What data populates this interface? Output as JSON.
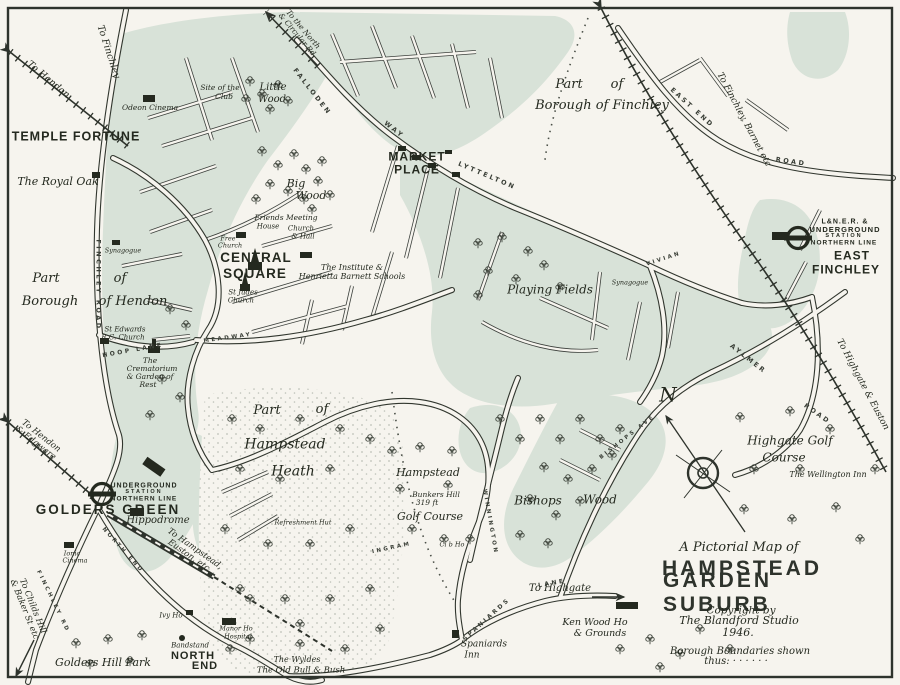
{
  "map_title": "A Pictorial Map of Hampstead Garden Suburb",
  "colors": {
    "paper": "#f6f4ee",
    "suburb_green": "#d8e2d8",
    "ink": "#2e332c"
  },
  "compass": {
    "n": "N"
  },
  "title_block": {
    "pretitle": "A Pictorial Map of",
    "title1": "HAMPSTEAD",
    "title2": "GARDEN SUBURB",
    "copyright1": "Copyright by",
    "copyright2": "The Blandford Studio",
    "copyright3": "1946.",
    "legend1": "Borough Boundaries shown",
    "legend2": "thus: · · · · · ·"
  },
  "stations": {
    "east_finchley": {
      "railway": "L&N.E.R. &",
      "underground": "UNDERGROUND",
      "station": "STATION",
      "line": "NORTHERN LINE",
      "name1": "EAST",
      "name2": "FINCHLEY"
    },
    "golders_green": {
      "underground": "UNDERGROUND",
      "station": "STATION",
      "line": "NORTHERN LINE",
      "name": "GOLDERS GREEN"
    }
  },
  "labels": {
    "temple_fortune": "TEMPLE FORTUNE",
    "market_place": [
      "MARKET",
      "PLACE"
    ],
    "central_square": [
      "CENTRAL",
      "SQUARE"
    ],
    "north_end": [
      "NORTH",
      "END"
    ],
    "royal_oak": "The Royal Oak",
    "hendon_part": [
      "Part",
      "of",
      "Borough",
      "of Hendon"
    ],
    "finchley_part": [
      "Part",
      "of",
      "Borough of Finchley"
    ],
    "little_wood": [
      "Little",
      "Wood"
    ],
    "big_wood": [
      "Big",
      "Wood"
    ],
    "site_of_club": [
      "Site of the",
      "Club"
    ],
    "odeon_cinema": "Odeon Cinema",
    "friends_meeting": [
      "Friends Meeting",
      "House"
    ],
    "church_hall": [
      "Church",
      "& Hall"
    ],
    "free_church": [
      "Free",
      "Church"
    ],
    "st_judes": [
      "St Judes",
      "Church"
    ],
    "institute": [
      "The Institute &",
      "Henrietta Barnett Schools"
    ],
    "synagogue_w": "Synagogue",
    "synagogue_e": "Synagogue",
    "st_edwards": [
      "St Edwards",
      "R.C. Church"
    ],
    "crematorium": [
      "The",
      "Crematorium",
      "& Garden of",
      "Rest"
    ],
    "playing_fields": "Playing Fields",
    "heath_part": [
      "Part",
      "of",
      "Hampstead",
      "Heath"
    ],
    "hampstead_golf": [
      "Hampstead",
      "Bunkers Hill",
      "319 ft",
      "Golf Course"
    ],
    "club_ho": "Cl b Ho",
    "bishops_wood": [
      "Bishops",
      "Wood"
    ],
    "highgate_golf": [
      "Highgate Golf",
      "Course"
    ],
    "wellington": "The Wellington Inn",
    "ken_wood": [
      "Ken Wood Ho",
      "& Grounds"
    ],
    "spaniards": [
      "Spaniards",
      "Inn"
    ],
    "wyldes": "The Wyldes",
    "old_bull": "The Old Bull & Bush",
    "golders_hill": "Golders Hill Park",
    "bandstand": "Bandstand",
    "ivy_ho": "Ivy Ho",
    "hippodrome": "Hippodrome",
    "ionic": [
      "Ionic",
      "Cinema"
    ],
    "refreshment": "Refreshment Hut",
    "manor": [
      "Manor Ho",
      "Hospital"
    ]
  },
  "roads": {
    "finchley_road": "FINCHLEY ROAD",
    "finchley2": "FINCHLEY RD",
    "hoop_lane": "HOOP LANE",
    "falloden": "FALLODEN",
    "way": "WAY",
    "lyttelton": "LYTTELTON",
    "east_end": "EAST END",
    "road_e": "ROAD",
    "aylmer": "AYLMER",
    "meadway": "MEADWAY",
    "vivian": "VIVIAN",
    "bishops_ave": "BISHOPS AVE",
    "winnington": "WINNINGTON",
    "spaniards_rd": "SPANIARDS",
    "lane": "LANE",
    "ingram": "INGRAM",
    "north_end_rd": "NORTH END",
    "road_s": "ROAD"
  },
  "directions": {
    "hendon": "To Hendon",
    "finchley": "To Finchley",
    "north": [
      "To the North",
      "& Circular Rd"
    ],
    "finchley_barnet": "To Finchley, Barnet etc",
    "highgate_euston": "To Highgate & Euston",
    "highgate": "To Highgate",
    "hampstead": [
      "To Hampstead,",
      "Euston, etc."
    ],
    "hendon_edgware": [
      "To Hendon",
      "& Edgware"
    ],
    "childs_hill": [
      "To Childs Hill",
      "& Baker St etc"
    ]
  }
}
